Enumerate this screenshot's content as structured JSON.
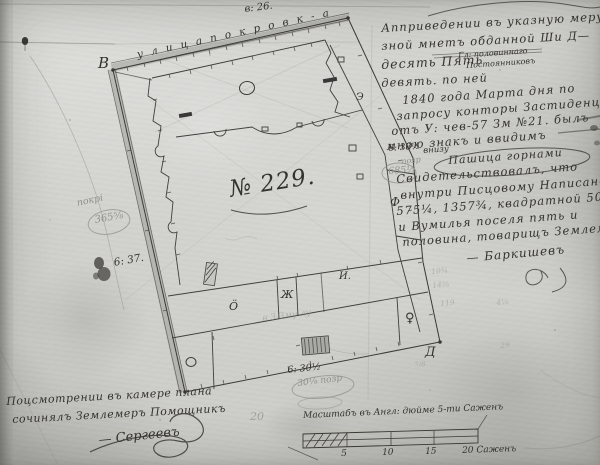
{
  "plan": {
    "street_label": "у л и ц а   п о к р о в к - а",
    "street_measure": "в: 26.",
    "parcel_number": "№ 229.",
    "corner_top_left": "В",
    "corner_bottom_right": "Д",
    "measure_left": "6: 37.",
    "measure_right": "6: 38½",
    "measure_right_note": "внизу",
    "measure_bottom": "6: 30½",
    "pencil_right_word": "позр",
    "pencil_right_value": "685½",
    "pencil_left_word": "покрi",
    "pencil_left_value": "365⅝",
    "pencil_bottom_value": "30⅛ позр",
    "pencil_bottom_note": "в З Зму лу",
    "pencil_page_number": "20",
    "symbols": {
      "e": "Э",
      "f": "Ф",
      "zh": "Ж",
      "i": "И.",
      "oe": "Ӧ",
      "venus": "♀"
    },
    "pencil_arithmetic": [
      "10¾",
      "14⅝",
      "119",
      "4⅛",
      "29",
      "7/8"
    ]
  },
  "notes_right": {
    "lines": [
      "Апприведении въ указную меру ока—",
      "зной мнетъ обданной Ши Д—",
      "десять Пять",
      "Гл: половиннаго",
      "Постоянниковъ",
      "девять. по ней",
      "1840 года Марта    дня по",
      "запросу конторы Застиденции",
      "отъ У: чев-57 Зм №21. былъ",
      "мною знакъ и ввидимъ",
      "Пашица горнами",
      "Свидетельствовалъ, что",
      "внутри Писцовому Написан—",
      "575¼, 1357¾, квадратной 508",
      "и Вумилья поселя пять и",
      "половина, товарищъ Землемеръ"
    ],
    "signature": "— Баркишевъ"
  },
  "notes_bottom_left": {
    "line1": "Поцсмотрении въ камере плана",
    "line2": "сочинялъ Землемеръ Помощникъ",
    "signature": "— Сергеевъ"
  },
  "scale_bar": {
    "label": "Масштабъ въ Англ: дюйме 5-ти Саженъ",
    "ticks": [
      "5",
      "10",
      "15",
      "20 Саженъ"
    ]
  }
}
